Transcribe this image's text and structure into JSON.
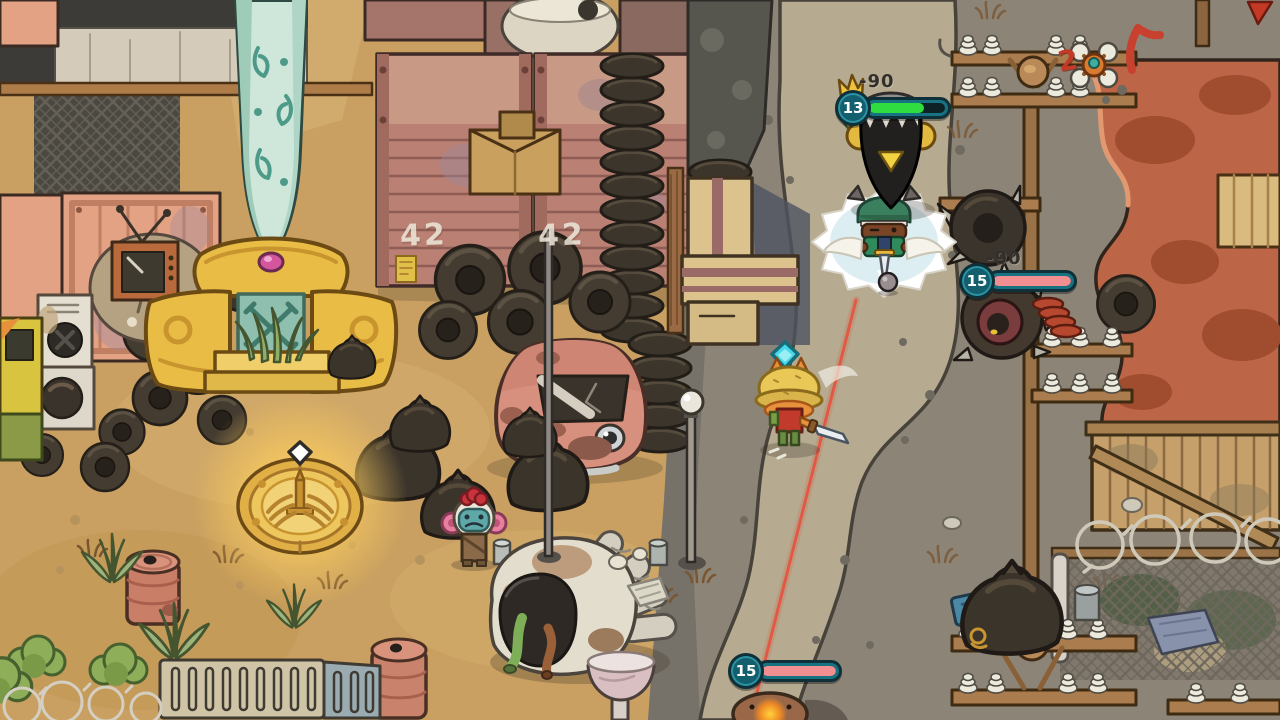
{
  "hud": {
    "crow": {
      "level": "13",
      "damage": "-90",
      "health_pct": "72%",
      "fill": "#2fdd40"
    },
    "tire": {
      "level": "15",
      "damage": "-90",
      "health_pct": "100%",
      "fill": "#f28f93"
    },
    "mole": {
      "level": "15",
      "health_pct": "100%",
      "fill": "#f28f93"
    }
  },
  "labels": {
    "container_a": "42",
    "container_b": "42",
    "pole_count": "2"
  },
  "icons": {
    "crown": "gold-crown",
    "waypoint": "white-diamond",
    "ally_marker": "cyan-diamond",
    "shrine_emblem": "winged-sword"
  },
  "colors": {
    "hud_shell": "#177381",
    "hud_outline": "#0f3038",
    "damage_text": "#33302b",
    "laser": "#e2543e",
    "sand": "#c9a061",
    "dirt": "#8d8478",
    "path": "#b6aa90",
    "cliff": "#bd6547",
    "shrine_glow": "#ffd98a"
  }
}
